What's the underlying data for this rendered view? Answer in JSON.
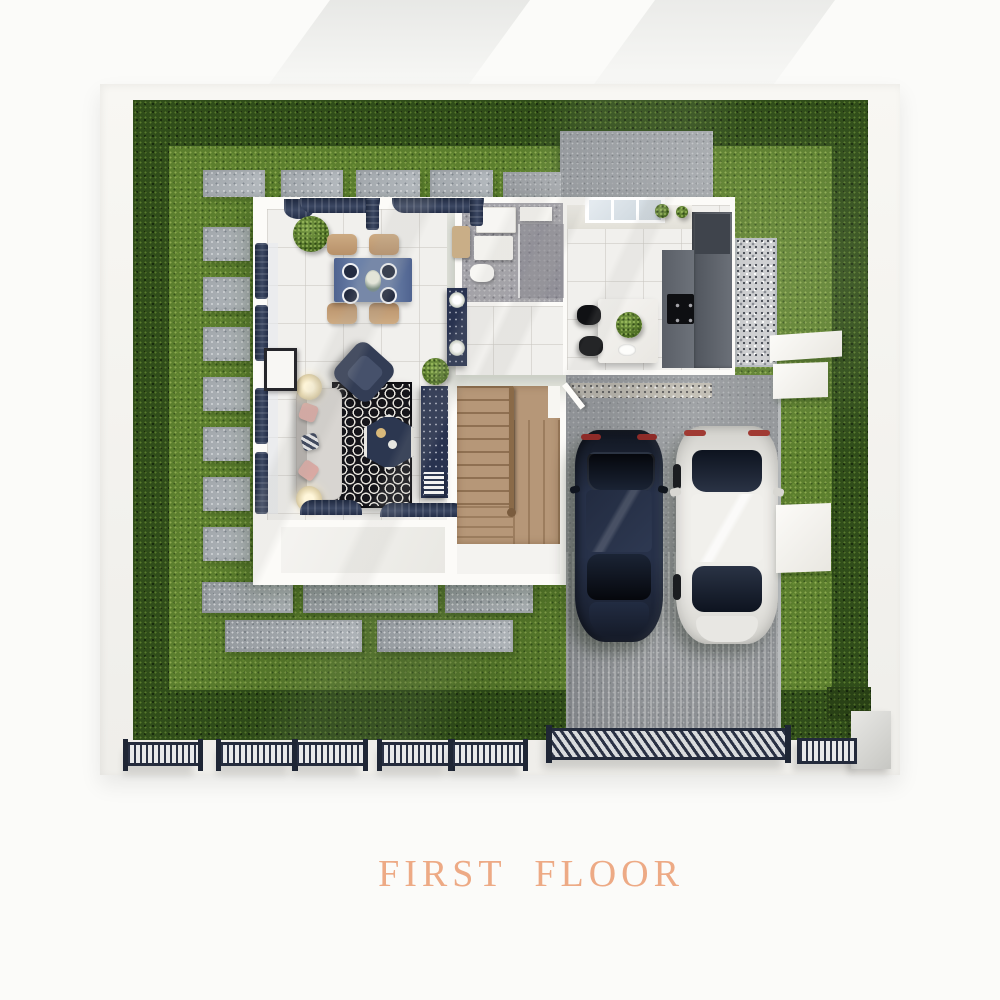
{
  "title": {
    "text": "FIRST FLOOR",
    "color": "#edaa85"
  },
  "palette": {
    "page_background": "#fbfbf9",
    "perimeter_walk": "#f4f3ef",
    "lawn_green": "#5c7f2e",
    "hedge_green": "#304d1a",
    "paver_gray": "#aeb4b9",
    "concrete_pad_gray": "#a2a6aa",
    "driveway_gray": "#9aa0a5",
    "gravel_light": "#cfd0d2",
    "house_white": "#fcfbf8",
    "tile_floor": "#f1f0ed",
    "bathroom_gray": "#a3a2a8",
    "kitchen_counter_charcoal": "#565b63",
    "stair_wood_tan": "#b79878",
    "navy_accent": "#2c3650",
    "rug_black": "#15151a",
    "car_dark_navy": "#232c3e",
    "car_white": "#ecebe7",
    "fence_iron": "#242b3c",
    "title_peach": "#edaa85"
  },
  "scene": {
    "rooms": [
      "dining-area",
      "living-room",
      "bathroom",
      "kitchen",
      "staircase",
      "entry-porch"
    ],
    "outdoor": [
      "front-lawn",
      "hedge-border",
      "stepping-stones",
      "back-patio-pad",
      "gravel-side-path",
      "driveway",
      "metal-fence",
      "sliding-driveway-gate",
      "pedestrian-gate",
      "gate-pillar",
      "planter-boxes"
    ],
    "vehicles": [
      "dark-blue-car",
      "white-car"
    ],
    "furniture": [
      "dining-table-for-four",
      "navy-curtains",
      "sofa",
      "accent-armchair",
      "patterned-rug",
      "hexagon-coffee-table",
      "tv-console",
      "table-lamps",
      "kitchen-island",
      "bar-stools",
      "cooktop",
      "bathroom-vanity",
      "potted-plants",
      "wood-stairs"
    ]
  }
}
